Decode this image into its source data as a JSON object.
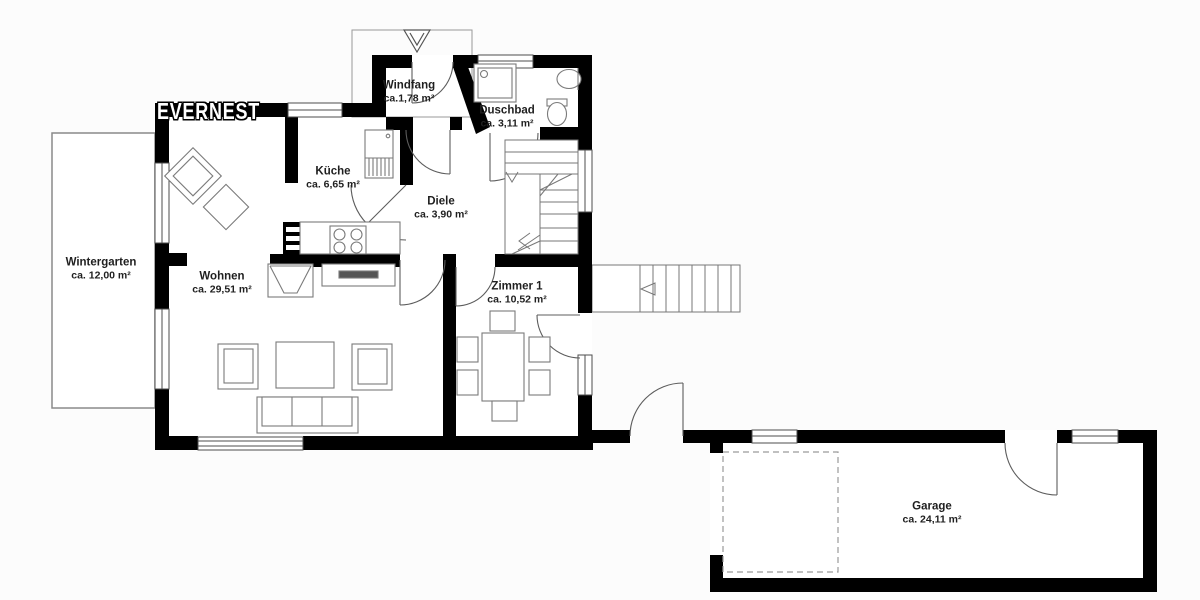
{
  "watermark": "EVERNEST",
  "rooms": [
    {
      "id": "wintergarten",
      "name": "Wintergarten",
      "area": "ca. 12,00 m²"
    },
    {
      "id": "wohnen",
      "name": "Wohnen",
      "area": "ca. 29,51 m²"
    },
    {
      "id": "kueche",
      "name": "Küche",
      "area": "ca. 6,65 m²"
    },
    {
      "id": "windfang",
      "name": "Windfang",
      "area": "ca.1,78 m²"
    },
    {
      "id": "duschbad",
      "name": "Duschbad",
      "area": "ca. 3,11 m²"
    },
    {
      "id": "diele",
      "name": "Diele",
      "area": "ca. 3,90 m²"
    },
    {
      "id": "zimmer1",
      "name": "Zimmer 1",
      "area": "ca. 10,52 m²"
    },
    {
      "id": "garage",
      "name": "Garage",
      "area": "ca. 24,11 m²"
    }
  ],
  "colors": {
    "wall": "#000000",
    "thin_line": "#777777",
    "door_line": "#5c5c5c",
    "dashed_line": "#9a9a9a",
    "background": "#fcfcfc",
    "label_text": "#1f1f1f"
  }
}
